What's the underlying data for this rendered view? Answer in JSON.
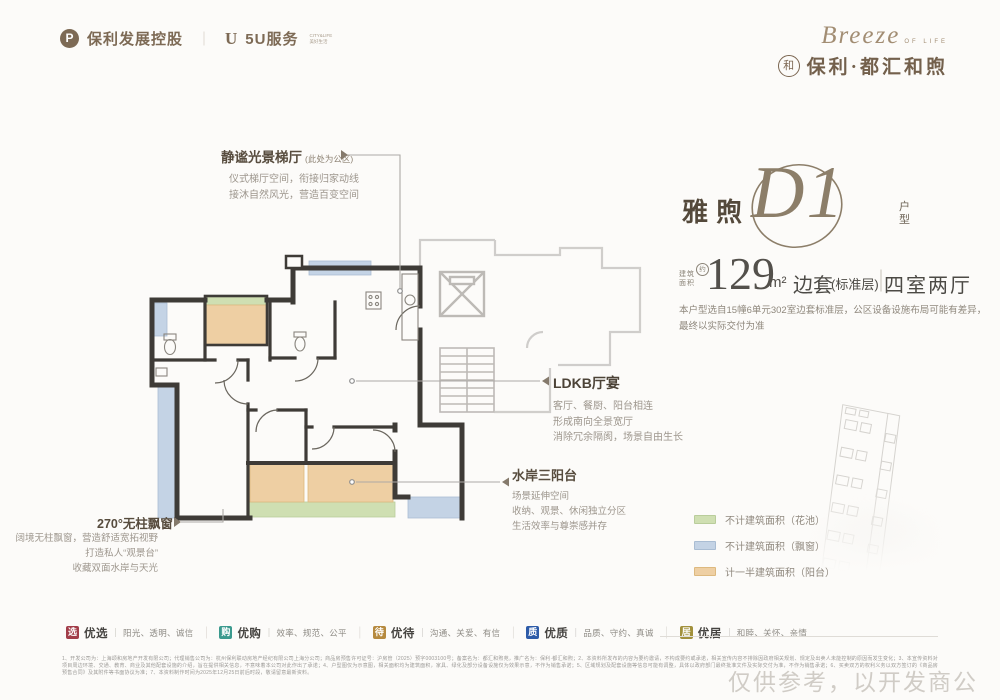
{
  "ui": {
    "pipe": "｜"
  },
  "header": {
    "dev_logo_mark": "P",
    "dev_logo_text": "保利发展控股",
    "service_logo_mark": "U",
    "service_logo_text": "5U服务",
    "service_tagline_1": "CITY&LIFE",
    "service_tagline_2": "美好生活",
    "brand_script": "Breeze",
    "brand_script_sub": "OF LIFE",
    "brand_seal_char": "和",
    "brand_name": "保利·都汇和煦"
  },
  "title_block": {
    "series": "雅煦",
    "plan_code": "D1",
    "type_char_1": "户",
    "type_char_2": "型",
    "area_label_top": "建筑",
    "area_label_bottom": "面积",
    "area_approx": "约",
    "area_value": "129",
    "area_unit": "m²",
    "unit_position": "边套",
    "floor_note": "(标准层)",
    "layout": "四室两厅",
    "note_line1": "本户型选自15幢6单元302室边套标准层，公区设备设施布局可能有差异，",
    "note_line2": "最终以实际交付为准"
  },
  "annotations": {
    "lobby": {
      "title": "静谧光景梯厅",
      "tag": "(此处为公区)",
      "lines": [
        "仪式梯厅空间，衔接归家动线",
        "接沐自然风光，营造百变空间"
      ]
    },
    "ldkb": {
      "title": "LDKB厅宴",
      "lines": [
        "客厅、餐厨、阳台相连",
        "形成南向全景宽厅",
        "消除冗余隔阂，场景自由生长"
      ]
    },
    "balcony": {
      "title": "水岸三阳台",
      "lines": [
        "场景延伸空间",
        "收纳、观景、休闲独立分区",
        "生活效率与尊崇感并存"
      ]
    },
    "baywindow": {
      "title": "270°无柱飘窗",
      "lines": [
        "阔境无柱飘窗，营造舒适宽拓视野",
        "打造私人“观景台”",
        "收藏双面水岸与天光"
      ]
    }
  },
  "legend": {
    "items": [
      {
        "label": "不计建筑面积（花池）",
        "color": "#cfdfb2"
      },
      {
        "label": "不计建筑面积（飘窗）",
        "color": "#c4d3e5"
      },
      {
        "label": "计一半建筑面积（阳台）",
        "color": "#eecfa3"
      }
    ]
  },
  "badges": {
    "items": [
      {
        "icon_char": "选",
        "name": "优选",
        "desc": "阳光、透明、诚信",
        "color": "#a23d49"
      },
      {
        "icon_char": "购",
        "name": "优购",
        "desc": "效率、规范、公平",
        "color": "#3b9a8e"
      },
      {
        "icon_char": "待",
        "name": "优待",
        "desc": "沟通、关爱、有信",
        "color": "#b68a3f"
      },
      {
        "icon_char": "质",
        "name": "优质",
        "desc": "品质、守约、真诚",
        "color": "#2d5ba8"
      },
      {
        "icon_char": "居",
        "name": "优居",
        "desc": "和睦、关怀、亲情",
        "color": "#a2913c"
      }
    ]
  },
  "footer": {
    "disclaimer": "1、开发公司为：上海颂和房地产开发有限公司；代理销售公司为：杭州保利联动房地产经纪有限公司上海分公司；商品房预售许可证号：沪房管（2025）预字0003100号；备案名为：都汇和煦苑，推广名为：保利·都汇和煦；2、本资料所发布的内容为要约邀请，不构成要约或承诺，相关宣传内容不排除因政府相关规划、规定及出卖人未能控制的原因而发生变化；3、本宣传资料对项目周边环境、交通、教育、商业及其他配套设施的介绍，旨在提供相关信息，不意味着本公司对此作出了承诺；4、户型图仅为示意图，相关面积均为建筑面积，家具、绿化及部分设备设施仅为效果示意，不作为销售承诺；5、区域规划及配套设施等信息可能有调整，具体以政府部门最终批准文件及实际交付为准，不作为销售承诺；6、买卖双方的权利义务以双方签订的《商品房预售合同》及其附件等书面协议为准；7、本资料制作时间为2025年12月25日前后时段，敬请留意最新资料。",
    "watermark": "仅供参考，以开发商公示为准"
  }
}
